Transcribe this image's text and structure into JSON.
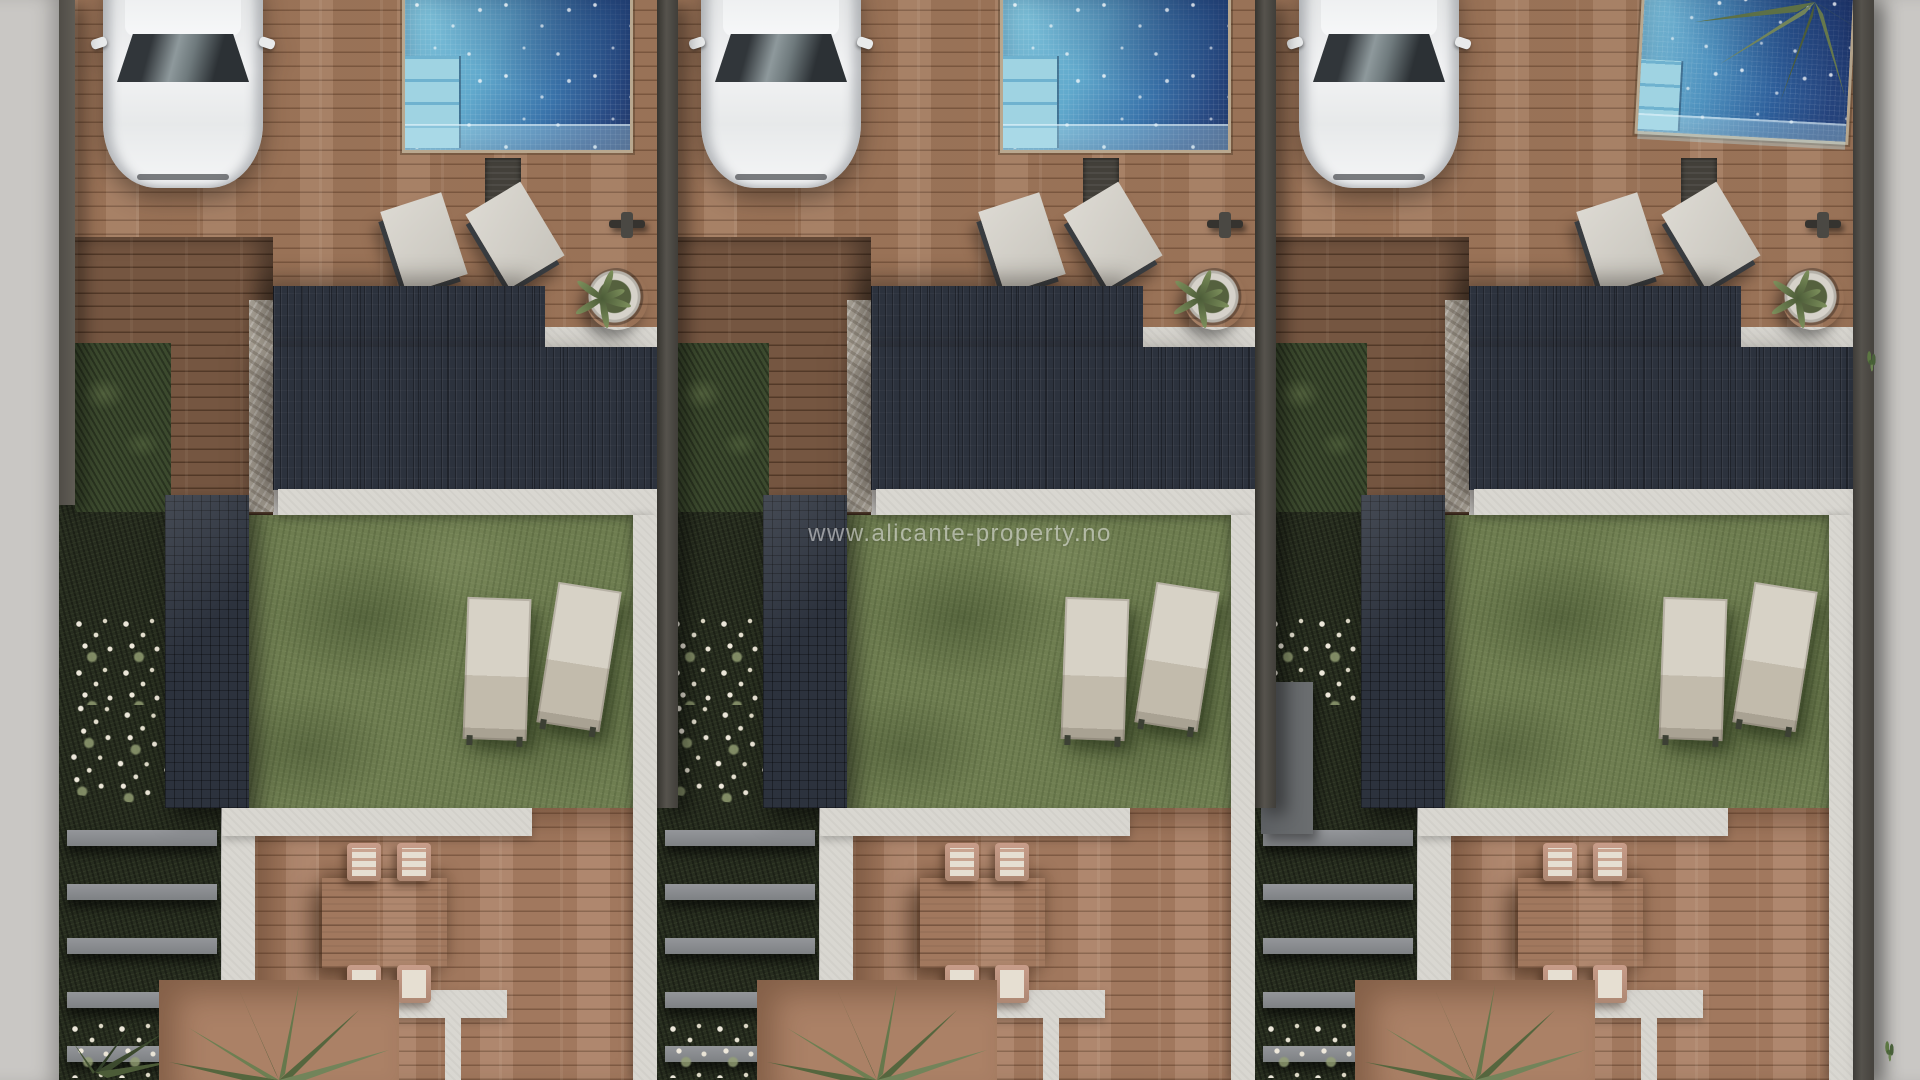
{
  "scene": {
    "type": "aerial-3d-architectural-render",
    "description": "Top-down 3D visualization of three identical modern terraced villas, each with driveway, parked white car, private pool, dark flat roofs, lawn with sun loungers, and brick patio with dining set",
    "watermark": "www.alicante-property.no",
    "units": [
      {
        "id": "villa-unit-1",
        "variant": "u1"
      },
      {
        "id": "villa-unit-2",
        "variant": "u2"
      },
      {
        "id": "villa-unit-3",
        "variant": "u3"
      }
    ],
    "objects_per_unit": [
      "white-car",
      "swimming-pool",
      "pool-steps",
      "upper-roof",
      "main-roof",
      "wing-roof",
      "garden-lawn",
      "two-sun-loungers",
      "two-deck-loungers",
      "potted-plant",
      "outdoor-shower",
      "door-mat",
      "dining-table",
      "four-chairs",
      "white-walkways",
      "garden-steps",
      "flower-beds",
      "palm-tree"
    ],
    "colors": {
      "brick": "#a27a5e",
      "patio": "#ab8166",
      "grass": "#6f7e51",
      "darkgarden": "#272d1f",
      "roof": "#2c323d",
      "walkway": "#d9d7d1",
      "sidewalk": "#c9c7c4",
      "pool_light": "#85c6db",
      "pool_dark": "#263c6e",
      "car_body": "#eceded",
      "lounger": "#d7d2c6",
      "table": "#c2a999",
      "flower": "#ece7da"
    }
  }
}
